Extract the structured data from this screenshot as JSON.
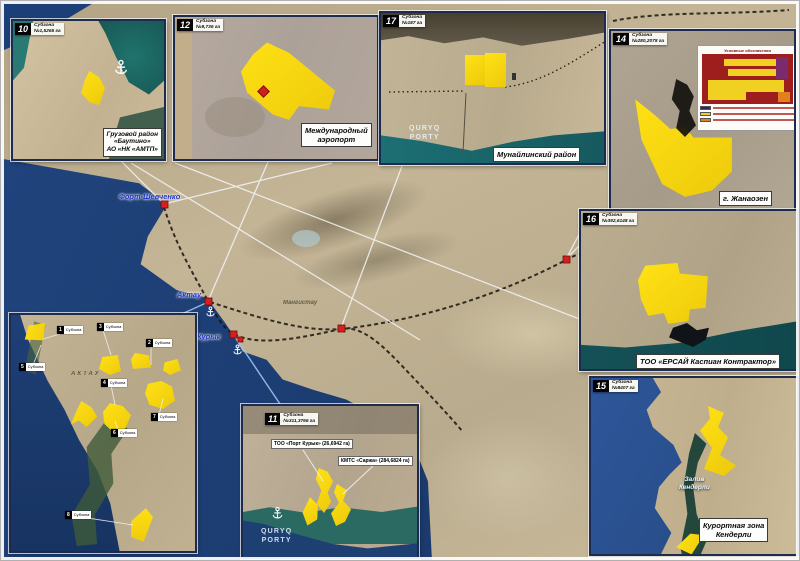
{
  "colors": {
    "sea": "#1d3f77",
    "land": "#b9aa8d",
    "zone_yellow": "#f7d712",
    "marker_red": "#d61f1f",
    "legend_navy": "#2e2668",
    "legend_yellow": "#f0d020",
    "legend_orange": "#e2801f",
    "inset_border": "#1c2b4e"
  },
  "map": {
    "cities": {
      "fort_shevchenko": "Форт-Шевченко",
      "aktau": "Актау",
      "kuryk": "Курык",
      "mangistau": "Мангистау"
    }
  },
  "insets": {
    "bautino": {
      "num": "10",
      "zone": "Субзона",
      "area": "№1,5265 га",
      "caption_lines": [
        "Грузовой район",
        "«Баутино»",
        "АО «НК «АМТП»"
      ]
    },
    "airport": {
      "num": "12",
      "zone": "Субзона",
      "area": "№9,736 га",
      "caption_lines": [
        "Международный",
        "аэропорт"
      ]
    },
    "munayly": {
      "num": "17",
      "zone": "Субзона",
      "area": "№187 га",
      "caption": "Мунайлинский район",
      "port_lines": [
        "QURYQ",
        "PORTY"
      ]
    },
    "zhanaozen": {
      "num": "14",
      "zone": "Субзона",
      "area": "№280,2078 га",
      "caption": "г. Жанаозен",
      "legend_title": "Условные обозначения"
    },
    "ersai": {
      "num": "16",
      "zone": "Субзона",
      "area": "№392,6148 га",
      "caption": "ТОО «ЕРСАЙ Каспиан Контрактор»"
    },
    "kenderli": {
      "num": "15",
      "zone": "Субзона",
      "area": "№8407 га",
      "caption_lines": [
        "Курортная зона",
        "Кендерли"
      ],
      "bay_lines": [
        "Залив",
        "Кендерли"
      ]
    },
    "kuryk_port": {
      "num": "11",
      "zone": "Субзона",
      "area": "№311,3766 га",
      "label_port": "ТОО «Порт Курык» (26,6942 га)",
      "label_sarzha": "КМТС «Саржа» (284,6824 га)",
      "port_lines": [
        "QURYQ",
        "PORTY"
      ]
    },
    "aktau_zones": {
      "city": "АКТАУ",
      "tag_label": "Субзона",
      "tags": [
        {
          "num": "1"
        },
        {
          "num": "3"
        },
        {
          "num": "2"
        },
        {
          "num": "5"
        },
        {
          "num": "4"
        },
        {
          "num": "7"
        },
        {
          "num": "6"
        },
        {
          "num": "8"
        }
      ]
    }
  }
}
